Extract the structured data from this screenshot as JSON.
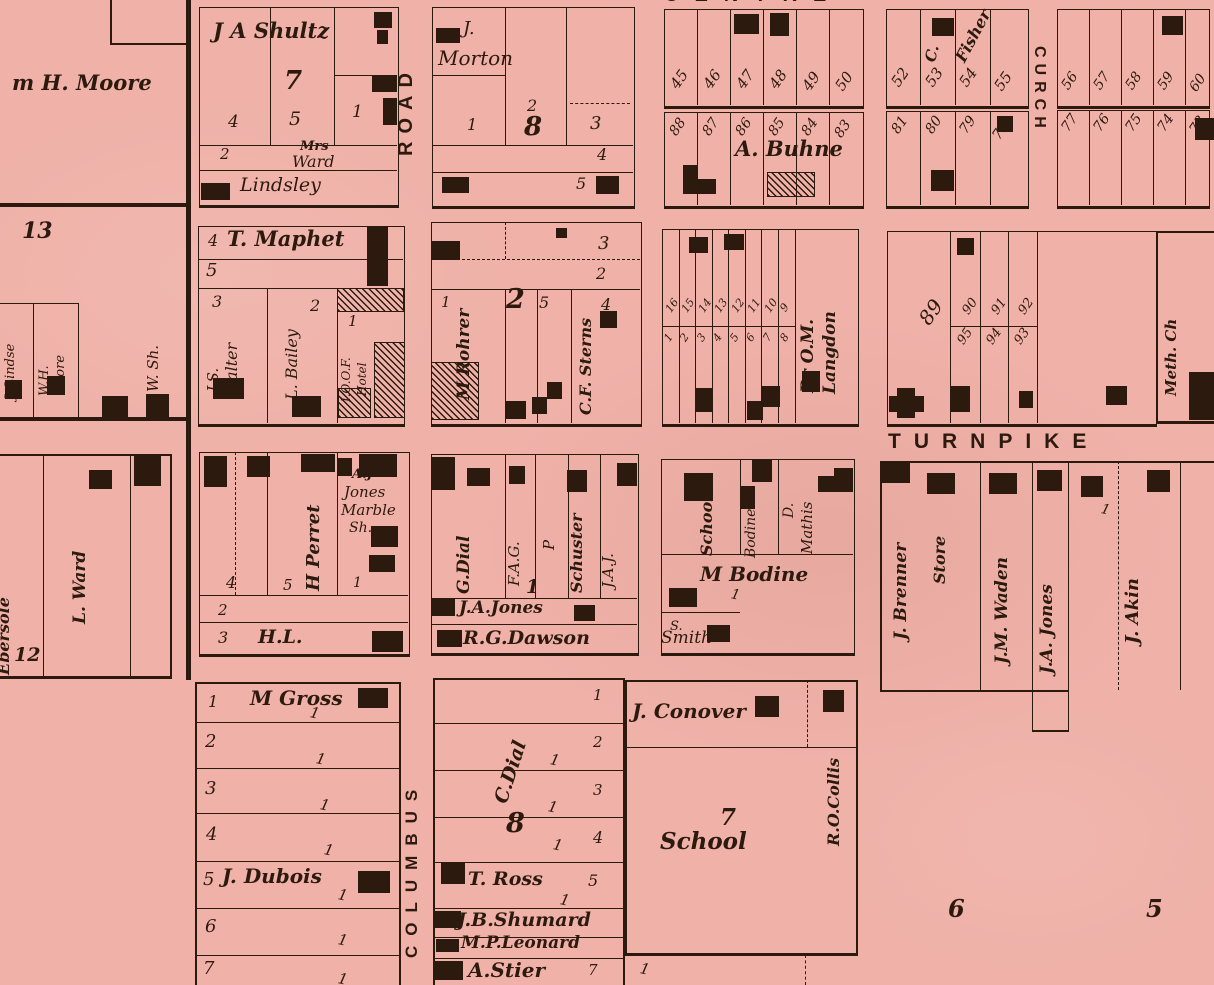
{
  "colors": {
    "paper": "#efb1a8",
    "ink": "#2d1a0e"
  },
  "streets": {
    "road": "ROAD",
    "centre": "CENTRE",
    "church": "CURCH",
    "turnpike": "TURNPIKE",
    "columbus": "COLUMBUS"
  },
  "tick": "1",
  "moore": {
    "owner": "m H. Moore"
  },
  "block13": {
    "number": "13",
    "lindse": "J. Lindse",
    "more_line1": "W.H.",
    "more_line2": "More",
    "wsh": "W. Sh."
  },
  "shultz": {
    "owner": "J A Shultz",
    "block": "7",
    "lot4": "4",
    "lot5": "5",
    "lot1": "1",
    "lot2": "2",
    "mrs": "Mrs",
    "ward": "Ward",
    "lindsley": "Lindsley"
  },
  "morton": {
    "owner1": "J.",
    "owner2": "Morton",
    "lot1": "1",
    "lot2": "2",
    "block": "8",
    "lot3": "3",
    "lot4": "4",
    "lot5": "5"
  },
  "centre_north": {
    "lots": [
      "45",
      "46",
      "47",
      "48",
      "49",
      "50"
    ]
  },
  "centre_south": {
    "lots": [
      "88",
      "87",
      "86",
      "85",
      "84",
      "83"
    ],
    "owner": "A. Buhne"
  },
  "fisher_north": {
    "lots": [
      "52",
      "53",
      "54",
      "55"
    ],
    "initial": "C.",
    "owner": "Fisher"
  },
  "fisher_south": {
    "lots": [
      "81",
      "80",
      "79",
      "78"
    ]
  },
  "east_north": {
    "lots": [
      "56",
      "57",
      "58",
      "59",
      "60"
    ]
  },
  "east_south": {
    "lots": [
      "77",
      "76",
      "75",
      "74",
      "73"
    ]
  },
  "maphet": {
    "lot4": "4",
    "owner": "T. Maphet",
    "lot5": "5",
    "lot3": "3",
    "walter1": "J.S.",
    "walter2": "Walter",
    "lot2": "2",
    "bailey": "L. Bailey",
    "lot1": "1",
    "ioof": "I.O.O.F.",
    "hotel": "Hotel"
  },
  "rohrer": {
    "lot3": "3",
    "lot2": "2",
    "lot1": "1",
    "owner": "M Rohrer",
    "block": "2",
    "lot5": "5",
    "lot4": "4",
    "sterns": "C.F. Sterns"
  },
  "langdon": {
    "top_lots": [
      "16",
      "15",
      "14",
      "13",
      "12",
      "11",
      "10",
      "9"
    ],
    "bottom_lots": [
      "1",
      "2",
      "3",
      "4",
      "5",
      "6",
      "7",
      "8"
    ],
    "owner1": "Dr O.M.",
    "owner2": "Langdon"
  },
  "ninety": {
    "lot89": "89",
    "top": [
      "90",
      "91",
      "92"
    ],
    "bottom": [
      "95",
      "94",
      "93"
    ]
  },
  "meth": {
    "label": "Meth. Ch"
  },
  "ward": {
    "ebersole": "Ebersole",
    "number": "12",
    "owner": "L. Ward"
  },
  "perret": {
    "aj": "A.J",
    "jones": "Jones",
    "marble": "Marble",
    "sh": "Sh.",
    "owner": "H Perret",
    "lot4": "4",
    "lot5": "5",
    "lot1": "1",
    "lot2": "2",
    "lot3": "3",
    "hl": "H.L."
  },
  "dialblock": {
    "gdial": "G.Dial",
    "fag": "F.A.G.",
    "p": "P",
    "schuster": "Schuster",
    "jaj": "J.A.J.",
    "block": "1",
    "jajones": "J.A.Jones",
    "dawson": "R.G.Dawson"
  },
  "bodine": {
    "school": "School",
    "bodine": "Bodine",
    "d": "D.",
    "mathis": "Mathis",
    "owner": "M Bodine",
    "s": "S.",
    "smith": "Smith"
  },
  "strip": {
    "brenner": "J. Brenner",
    "store": "Store",
    "waden": "J.M. Waden",
    "jones": "J.A. Jones",
    "akin": "J. Akin"
  },
  "gross": {
    "lot1": "1",
    "owner": "M Gross",
    "lot2": "2",
    "lot3": "3",
    "lot4": "4",
    "lot5": "5",
    "dubois": "J. Dubois",
    "lot6": "6",
    "lot7": "7"
  },
  "dial8": {
    "lot1": "1",
    "lot2": "2",
    "lot3": "3",
    "lot4": "4",
    "owner": "C.Dial",
    "block": "8",
    "ross": "T. Ross",
    "lot5": "5",
    "shumard": "J.B.Shumard",
    "leonard": "M.P.Leonard",
    "stier": "A.Stier",
    "lot7": "7"
  },
  "conover": {
    "owner": "J. Conover",
    "collis": "R.O.Collis",
    "block": "7",
    "school": "School"
  },
  "numbers": {
    "six": "6",
    "five": "5"
  }
}
